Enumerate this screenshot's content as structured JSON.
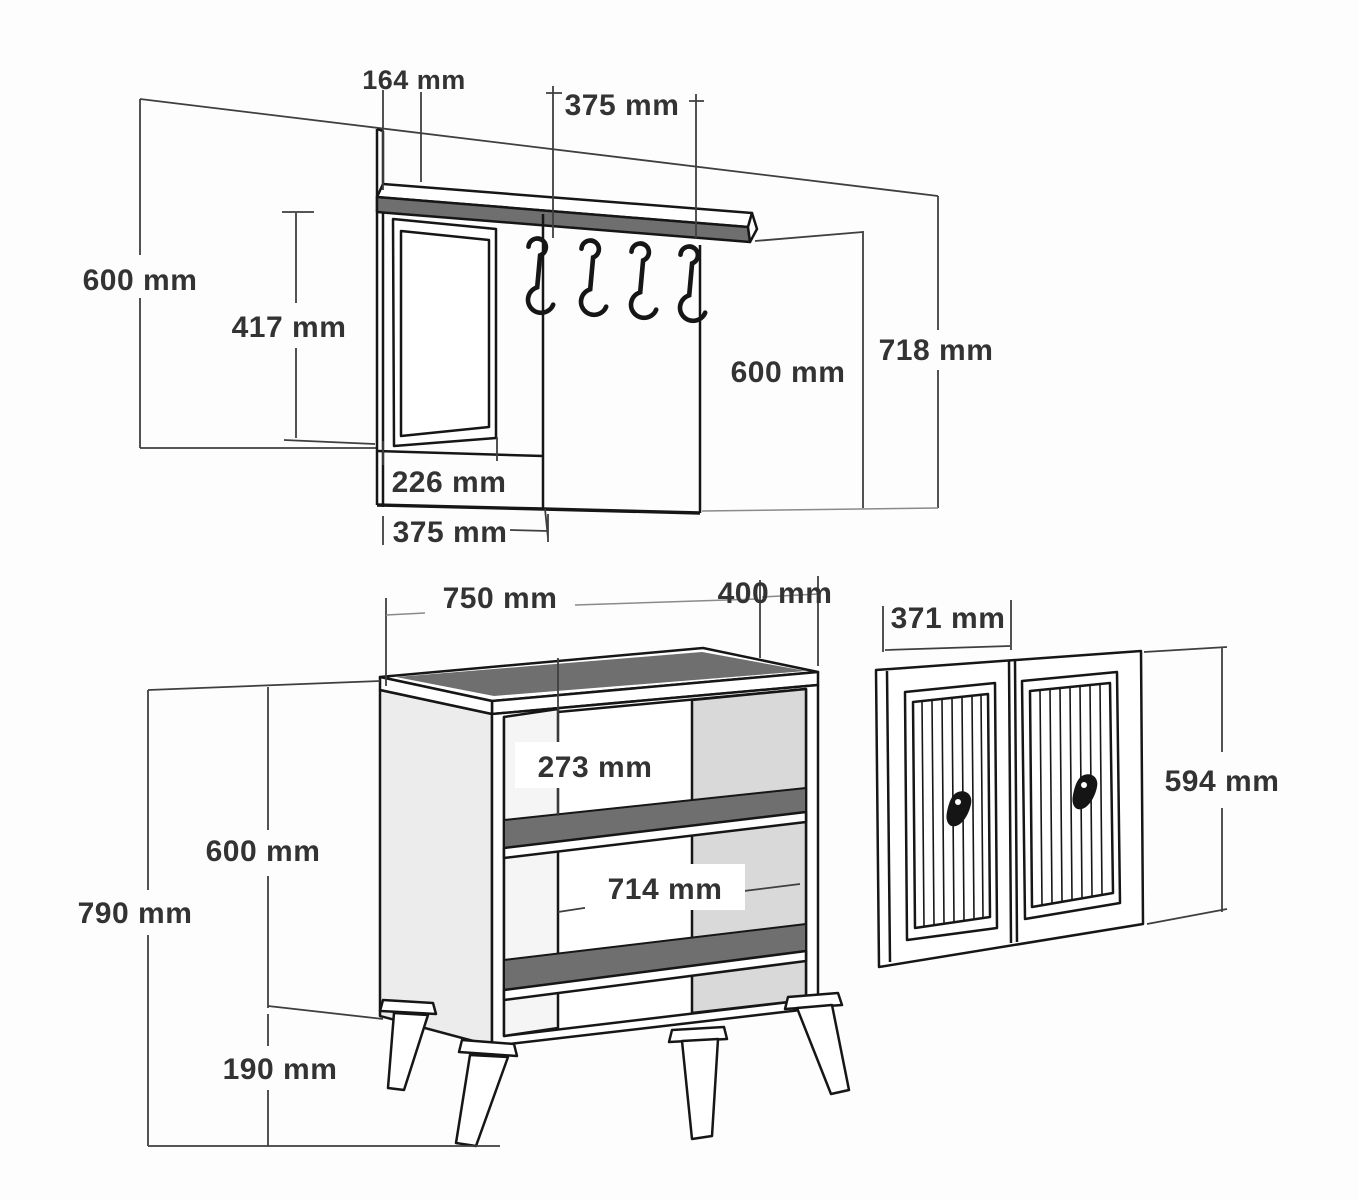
{
  "title": "Hallway furniture set dimension drawing",
  "units": "mm",
  "colors": {
    "background": "#ffffff",
    "outline": "#161616",
    "panel_dark": "#6f6f6f",
    "panel_light": "#d9d9d9",
    "side_light": "#ececec",
    "label_text": "#333333"
  },
  "coat_rack": {
    "shelf_depth": "164 mm",
    "hook_panel_width_top": "375 mm",
    "left_height": "600 mm",
    "mirror_height": "417 mm",
    "mirror_width": "226 mm",
    "panel_width_bottom": "375 mm",
    "hook_panel_height": "600 mm",
    "total_height": "718 mm",
    "hook_count": 4
  },
  "cabinet": {
    "width": "750 mm",
    "depth": "400 mm",
    "body_height": "600 mm",
    "total_height": "790 mm",
    "leg_height": "190 mm",
    "shelf_gap": "273 mm",
    "inner_width": "714 mm",
    "leg_count": 4,
    "shelf_count": 2
  },
  "doors": {
    "door_width": "371 mm",
    "door_height": "594 mm",
    "door_count": 2
  }
}
